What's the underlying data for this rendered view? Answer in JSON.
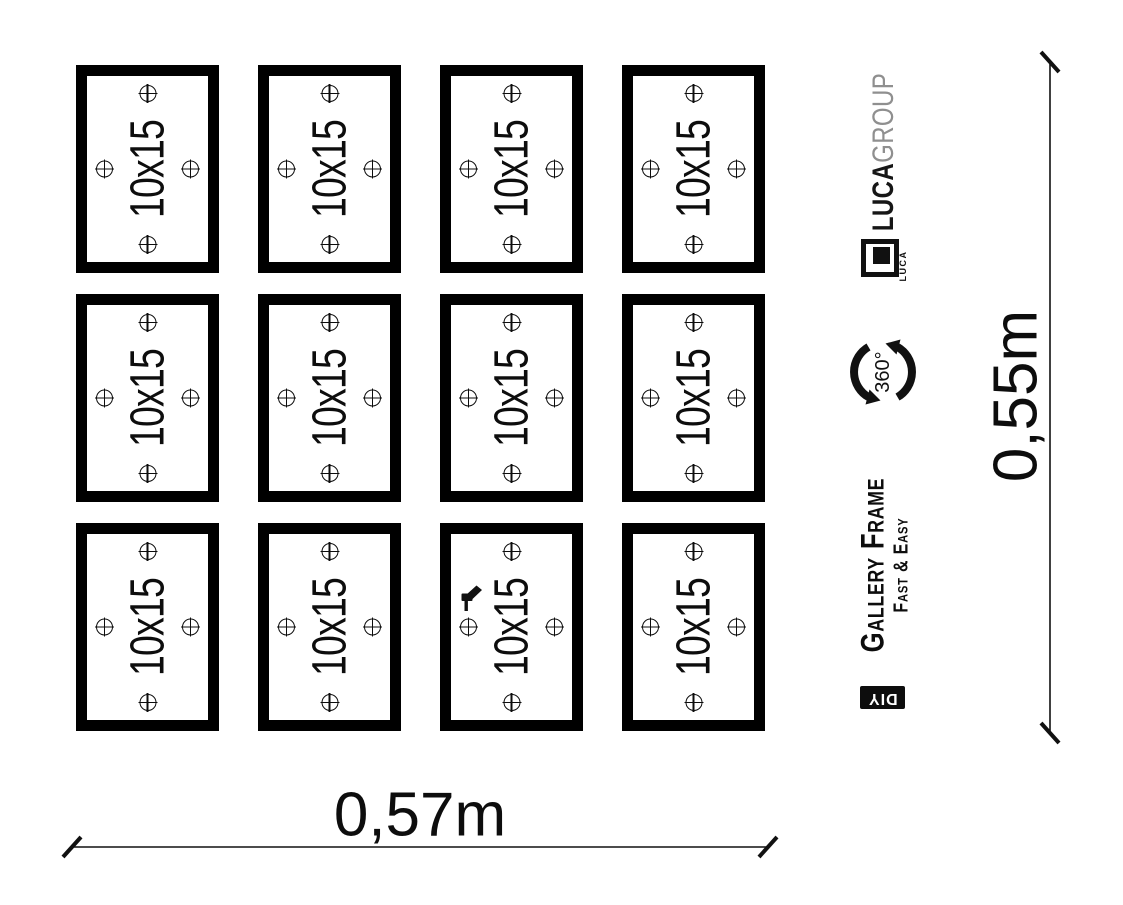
{
  "frames": {
    "rows": 3,
    "cols": 4,
    "count": 12,
    "items": [
      {
        "label": "10x15"
      },
      {
        "label": "10x15"
      },
      {
        "label": "10x15"
      },
      {
        "label": "10x15"
      },
      {
        "label": "10x15"
      },
      {
        "label": "10x15"
      },
      {
        "label": "10x15"
      },
      {
        "label": "10x15"
      },
      {
        "label": "10x15"
      },
      {
        "label": "10x15"
      },
      {
        "label": "10x15"
      },
      {
        "label": "10x15"
      }
    ]
  },
  "dimensions": {
    "width_label": "0,57m",
    "height_label": "0,55m"
  },
  "branding": {
    "brand_bold": "LUCA",
    "brand_light": "GROUP",
    "logo_caption": "LUCA",
    "rotation_label": "360°",
    "product_name": "Gallery Frame",
    "product_tagline": "Fast & Easy",
    "diy_label": "DIY"
  },
  "icons": {
    "marker": "crosshair-icon",
    "tool": "drill-icon",
    "rotation": "rotation-arrows-icon"
  },
  "colors": {
    "ink": "#0d0d0d",
    "frame_border": "#000000",
    "brand_gray": "#8f8f8f",
    "background": "#ffffff"
  }
}
